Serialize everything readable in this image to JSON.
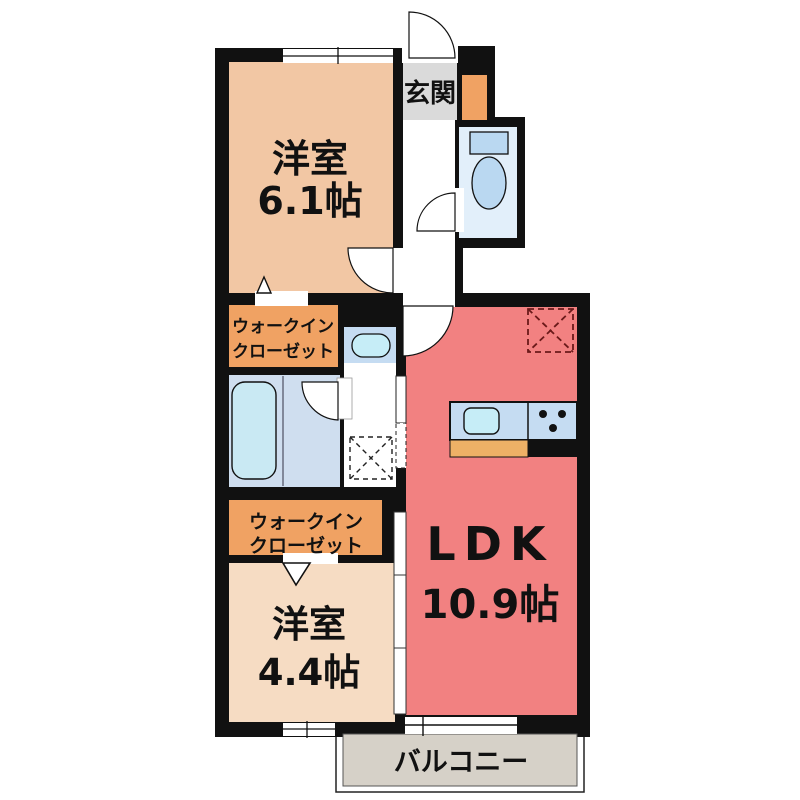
{
  "plan": {
    "title": "apartment-floor-plan",
    "rooms": [
      {
        "id": "western-room-1",
        "name": "洋室",
        "size": "6.1帖"
      },
      {
        "id": "entrance",
        "name": "玄関",
        "size": ""
      },
      {
        "id": "walk-in-closet-1",
        "name": "ウォークイン",
        "name2": "クローゼット",
        "size": ""
      },
      {
        "id": "ldk",
        "name": "LDK",
        "size": "10.9帖"
      },
      {
        "id": "walk-in-closet-2",
        "name": "ウォークイン",
        "name2": "クローゼット",
        "size": ""
      },
      {
        "id": "western-room-2",
        "name": "洋室",
        "size": "4.4帖"
      },
      {
        "id": "balcony",
        "name": "バルコニー",
        "size": ""
      }
    ],
    "fixtures": [
      "toilet-icon",
      "bathtub-icon",
      "washbasin-icon",
      "kitchen-sink-icon",
      "stove-icon",
      "washing-machine-space-icon",
      "refrigerator-space-icon",
      "shoe-cabinet-icon",
      "door-swing-icon",
      "sliding-window-icon",
      "sliding-door-icon",
      "folding-door-icon"
    ],
    "colors": {
      "wall": "#111111",
      "room_6_1": "#f2c7a4",
      "room_4_4": "#f6dcc3",
      "closet": "#f0a263",
      "ldk": "#f28181",
      "bathroom": "#cfdeef",
      "toilet_floor": "#e2effa",
      "fixture_blue": "#bad8f1",
      "tub": "#c9e9f3",
      "counter": "#c5dcf2",
      "sink": "#c6edf7",
      "entrance_gray": "#dadada",
      "balcony_gray": "#d6d1c8",
      "counter_front": "#eeb166"
    }
  }
}
